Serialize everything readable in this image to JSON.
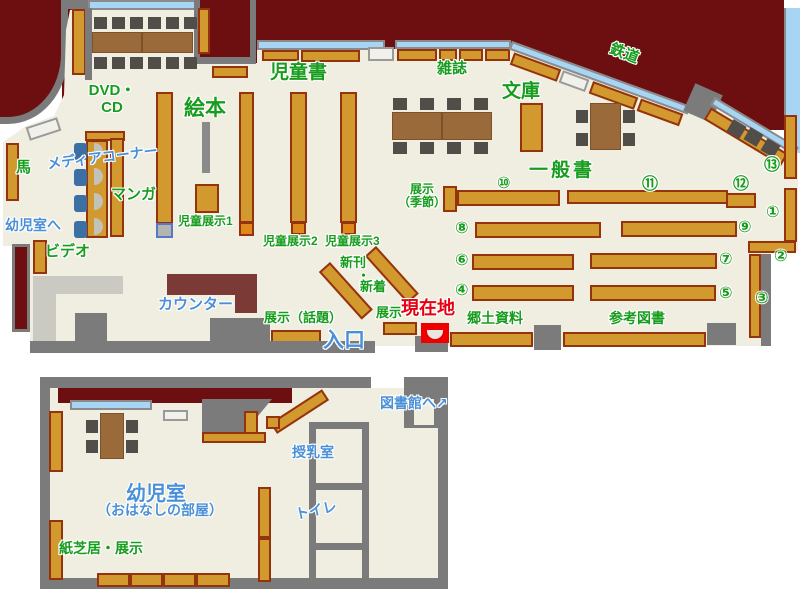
{
  "colors": {
    "outside_wall": "#6d0f11",
    "floor": "#efeee0",
    "shelf": "#d2992e",
    "shelf_border": "#96330f",
    "wall_gray": "#7b7b7b",
    "window_blue": "#a9d5f5",
    "label_green": "#189c1d",
    "label_blue": "#4a90d8",
    "label_red": "#e60012",
    "counter_maroon": "#7b3a36"
  },
  "upper": {
    "labels": {
      "children_books": "児童書",
      "picture_books": "絵本",
      "magazines": "雑誌",
      "bunko": "文庫",
      "railway": "鉄道",
      "general_books": "一般書",
      "dvd_cd": "DVD・\nCD",
      "media_corner": "メディアコーナー",
      "manga": "マンガ",
      "horse": "馬",
      "to_infant_room": "幼児室へ",
      "video": "ビデオ",
      "counter": "カウンター",
      "children_exhibit1": "児童展示1",
      "children_exhibit2": "児童展示2",
      "children_exhibit3": "児童展示3",
      "new_arrivals_1": "新刊",
      "new_arrivals_dot": "・",
      "new_arrivals_2": "新着",
      "exhibit_seasonal": "展示\n（季節）",
      "exhibit_topical": "展示（話題）",
      "exhibit": "展示",
      "current_location": "現在地",
      "entrance": "入口",
      "local_materials": "郷土資料",
      "reference_books": "参考図書"
    },
    "circles": [
      "①",
      "②",
      "③",
      "④",
      "⑤",
      "⑥",
      "⑦",
      "⑧",
      "⑨",
      "⑩",
      "⑪",
      "⑫",
      "⑬"
    ]
  },
  "lower": {
    "labels": {
      "infant_room": "幼児室",
      "story_room": "（おはなしの部屋）",
      "kamishibai_exhibit": "紙芝居・展示",
      "nursing_room": "授乳室",
      "toilet": "トイレ",
      "to_library": "図書館へ",
      "to_library_arrow": "↗"
    }
  }
}
